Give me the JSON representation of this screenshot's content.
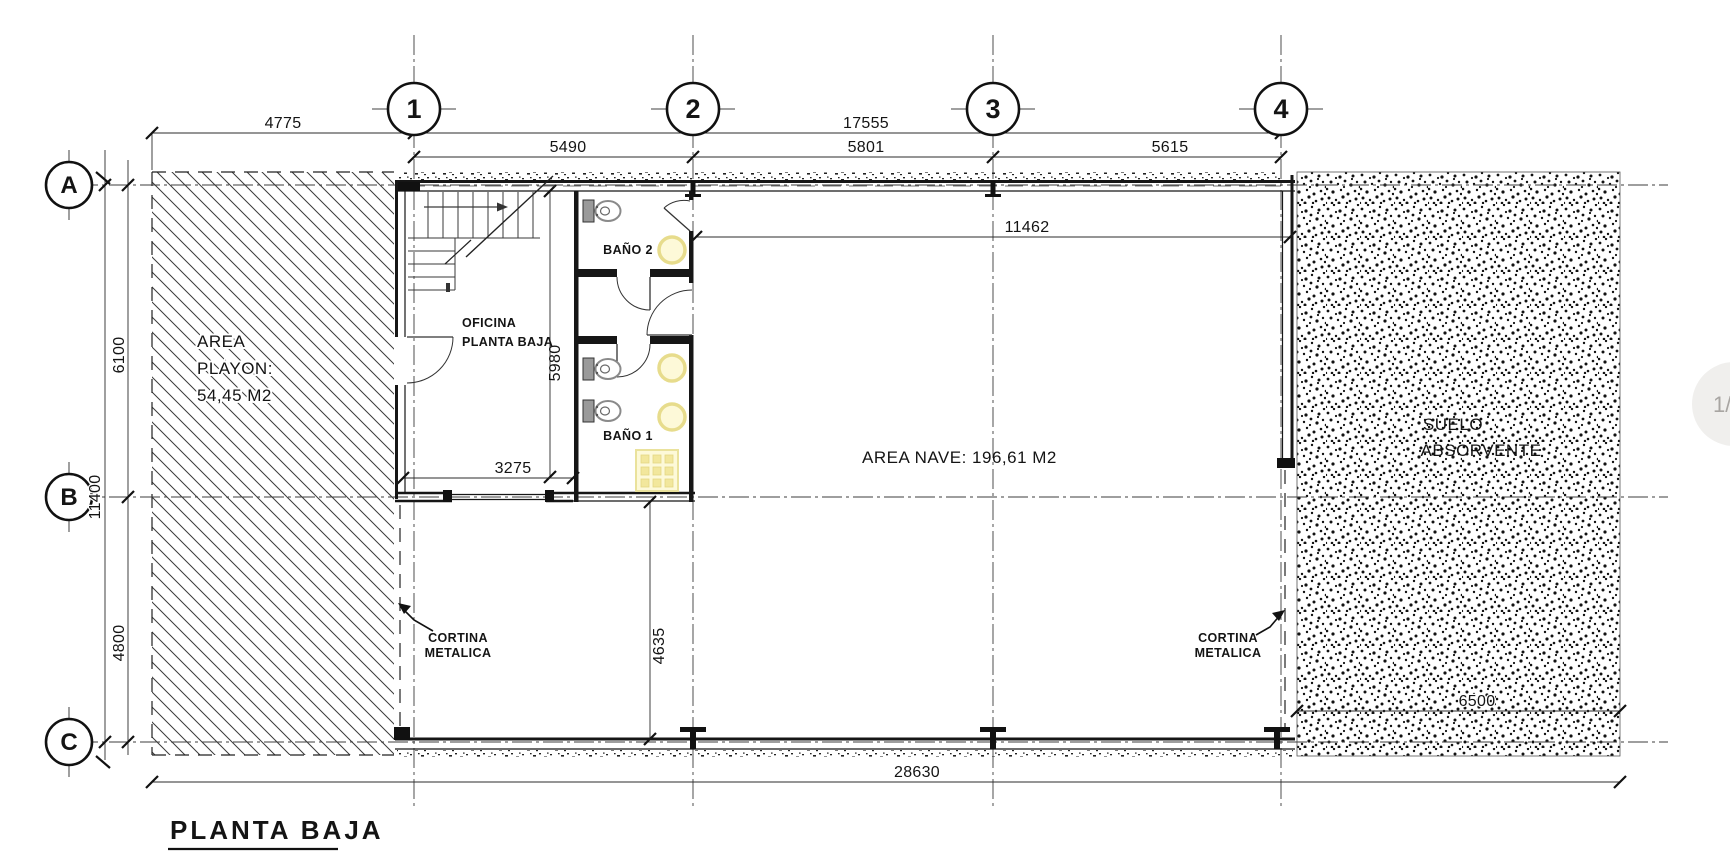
{
  "page_overlay": {
    "badge": "1/"
  },
  "title": {
    "text": "PLANTA BAJA"
  },
  "grid": {
    "cols": [
      "1",
      "2",
      "3",
      "4"
    ],
    "rows": [
      "A",
      "B",
      "C"
    ]
  },
  "dims": {
    "top_left": "4775",
    "top_total": "17555",
    "span_1_2": "5490",
    "span_2_3": "5801",
    "span_3_4": "5615",
    "nave_width": "11462",
    "left_a_b": "6100",
    "left_total": "11400",
    "left_b_c": "4800",
    "office_height": "5980",
    "office_width": "3275",
    "lower_height": "4635",
    "suelo_width": "6500",
    "bottom_total": "28630"
  },
  "rooms": {
    "playon": [
      "AREA",
      "PLAYON:",
      "54,45 M2"
    ],
    "office": [
      "OFICINA",
      "PLANTA BAJA"
    ],
    "bath2": "BAÑO 2",
    "bath1": "BAÑO 1",
    "nave": "AREA NAVE: 196,61 M2",
    "suelo": [
      "SUELO",
      "ABSORVENTE"
    ]
  },
  "annotations": {
    "cortina_left": [
      "CORTINA",
      "METALICA"
    ],
    "cortina_right": [
      "CORTINA",
      "METALICA"
    ]
  }
}
